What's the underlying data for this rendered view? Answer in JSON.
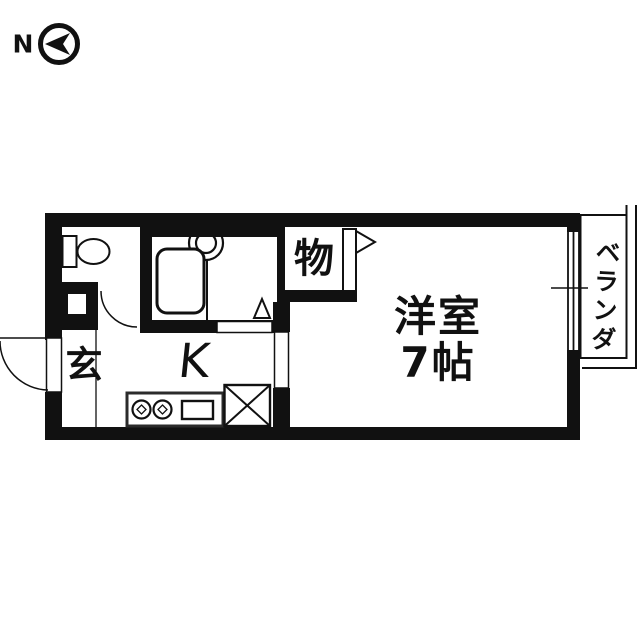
{
  "compass": {
    "label": "N",
    "icon": "compass-west-arrow-icon"
  },
  "labels": {
    "north": "N",
    "genkan": "玄",
    "kitchen": "K",
    "closet": "物",
    "main_room_name": "洋室",
    "main_room_size": "7帖",
    "veranda": "ベランダ"
  },
  "fixtures": [
    "toilet-fixture",
    "bathtub-fixture",
    "wash-basin-fixture",
    "bath-door-triangle",
    "entrance-door-arc",
    "toilet-door-arc",
    "closet-door-panel",
    "closet-door-swing-flag",
    "kitchen-counter",
    "stove-burners",
    "kitchen-sink",
    "appliance-space-x",
    "sliding-door-veranda"
  ],
  "colors": {
    "ink": "#111111",
    "paper": "#ffffff",
    "counter_outline": "#2b2b2b"
  }
}
